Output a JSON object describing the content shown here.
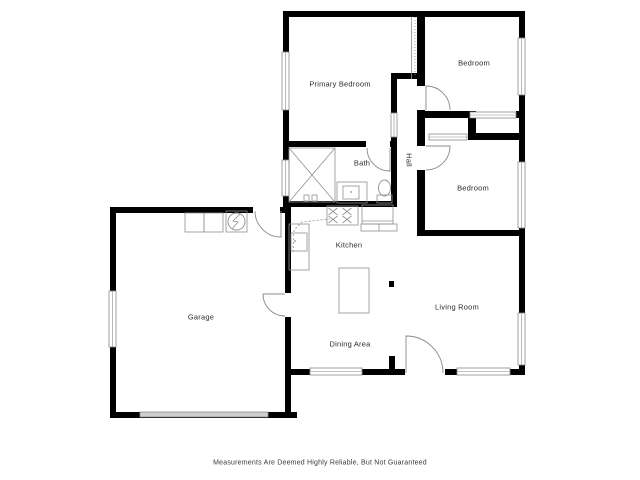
{
  "disclaimer": "Measurements Are Deemed Highly Reliable, But Not Guaranteed",
  "colors": {
    "wall": "#000000",
    "line": "#8a8a8a",
    "fixture": "#909090",
    "garage_door_fill": "#cfcfcf",
    "text": "#2b2b2b"
  },
  "rooms": [
    {
      "name": "primary-bedroom",
      "label": "Primary Bedroom",
      "cx": 340,
      "cy": 84
    },
    {
      "name": "bedroom-top",
      "label": "Bedroom",
      "cx": 474,
      "cy": 63
    },
    {
      "name": "bedroom-middle",
      "label": "Bedroom",
      "cx": 473,
      "cy": 188
    },
    {
      "name": "bath",
      "label": "Bath",
      "cx": 362,
      "cy": 163
    },
    {
      "name": "hall",
      "label": "Hall",
      "cx": 409,
      "cy": 160,
      "vertical": true
    },
    {
      "name": "kitchen",
      "label": "Kitchen",
      "cx": 349,
      "cy": 245
    },
    {
      "name": "garage",
      "label": "Garage",
      "cx": 201,
      "cy": 317
    },
    {
      "name": "living-room",
      "label": "Living Room",
      "cx": 457,
      "cy": 307
    },
    {
      "name": "dining-area",
      "label": "Dining Area",
      "cx": 350,
      "cy": 344
    }
  ],
  "floorplan": {
    "walls": [
      {
        "name": "wall-top",
        "x": 283,
        "y": 11,
        "w": 242,
        "h": 6
      },
      {
        "name": "wall-right",
        "x": 519,
        "y": 11,
        "w": 6,
        "h": 364
      },
      {
        "name": "wall-bottom",
        "x": 291,
        "y": 369,
        "w": 234,
        "h": 6
      },
      {
        "name": "wall-left-upper",
        "x": 283,
        "y": 11,
        "w": 6,
        "h": 196
      },
      {
        "name": "wall-primary-bottom",
        "x": 283,
        "y": 141,
        "w": 114,
        "h": 6
      },
      {
        "name": "wall-bath-bottom",
        "x": 283,
        "y": 201,
        "w": 114,
        "h": 6
      },
      {
        "name": "wall-bath-hall",
        "x": 391,
        "y": 73,
        "w": 6,
        "h": 134
      },
      {
        "name": "wall-hall-top",
        "x": 391,
        "y": 73,
        "w": 30,
        "h": 6
      },
      {
        "name": "wall-bedrooms-left",
        "x": 417,
        "y": 11,
        "w": 8,
        "h": 225
      },
      {
        "name": "wall-closet-top",
        "x": 417,
        "y": 111,
        "w": 53,
        "h": 7
      },
      {
        "name": "wall-closet-top-right",
        "x": 516,
        "y": 111,
        "w": 9,
        "h": 7
      },
      {
        "name": "wall-closet-divider",
        "x": 468,
        "y": 111,
        "w": 8,
        "h": 29
      },
      {
        "name": "wall-closet-bottom",
        "x": 468,
        "y": 133,
        "w": 57,
        "h": 7
      },
      {
        "name": "wall-bedroom2-bottom",
        "x": 417,
        "y": 230,
        "w": 108,
        "h": 6
      },
      {
        "name": "wall-garage-top",
        "x": 110,
        "y": 207,
        "w": 181,
        "h": 6
      },
      {
        "name": "wall-garage-left",
        "x": 110,
        "y": 207,
        "w": 6,
        "h": 211
      },
      {
        "name": "wall-garage-bottom",
        "x": 110,
        "y": 412,
        "w": 187,
        "h": 6
      },
      {
        "name": "wall-garage-right",
        "x": 285,
        "y": 207,
        "w": 6,
        "h": 211
      },
      {
        "name": "wall-entry-stub",
        "x": 389,
        "y": 356,
        "w": 6,
        "h": 19
      }
    ],
    "openings": [
      {
        "name": "opening-bedroom-top-door",
        "x": 416,
        "y": 86,
        "w": 10,
        "h": 24
      },
      {
        "name": "opening-bedroom-middle-door",
        "x": 416,
        "y": 146,
        "w": 10,
        "h": 24
      },
      {
        "name": "opening-bath-door",
        "x": 366,
        "y": 141,
        "w": 24,
        "h": 6
      },
      {
        "name": "opening-garage-entry",
        "x": 253,
        "y": 207,
        "w": 27,
        "h": 6
      },
      {
        "name": "opening-garage-side",
        "x": 285,
        "y": 293,
        "w": 6,
        "h": 24
      },
      {
        "name": "opening-front-door",
        "x": 405,
        "y": 369,
        "w": 40,
        "h": 6
      }
    ],
    "windows": [
      {
        "name": "window-primary-left",
        "x": 282,
        "y": 52,
        "w": 7,
        "h": 58
      },
      {
        "name": "window-bath-left",
        "x": 282,
        "y": 160,
        "w": 7,
        "h": 36
      },
      {
        "name": "window-bedroom-top-right",
        "x": 518,
        "y": 38,
        "w": 7,
        "h": 57
      },
      {
        "name": "window-bedroom-middle-right",
        "x": 518,
        "y": 162,
        "w": 7,
        "h": 66
      },
      {
        "name": "window-living-right",
        "x": 518,
        "y": 313,
        "w": 7,
        "h": 52
      },
      {
        "name": "window-dining-bottom",
        "x": 310,
        "y": 368,
        "w": 52,
        "h": 7
      },
      {
        "name": "window-living-bottom",
        "x": 457,
        "y": 368,
        "w": 53,
        "h": 7
      },
      {
        "name": "window-garage-left",
        "x": 109,
        "y": 291,
        "w": 7,
        "h": 56
      },
      {
        "name": "closet-door-bedroom-top",
        "x": 470,
        "y": 112,
        "w": 46,
        "h": 6
      },
      {
        "name": "closet-door-bedroom-middle",
        "x": 429,
        "y": 134,
        "w": 38,
        "h": 6
      },
      {
        "name": "opening-primary-hall",
        "x": 391,
        "y": 113,
        "w": 6,
        "h": 24
      }
    ],
    "garage_door": {
      "name": "garage-door",
      "x": 140,
      "y": 412,
      "w": 128,
      "h": 5
    },
    "doors": [
      {
        "name": "bedroom-top-door",
        "cx": 426,
        "cy": 110,
        "r": 24,
        "leaf": 270,
        "open": 0
      },
      {
        "name": "bedroom-middle-door",
        "cx": 426,
        "cy": 146,
        "r": 24,
        "leaf": 0,
        "open": 90
      },
      {
        "name": "bath-door",
        "cx": 390,
        "cy": 148,
        "r": 23,
        "leaf": 90,
        "open": 180
      },
      {
        "name": "garage-entry-door",
        "cx": 281,
        "cy": 211,
        "r": 26,
        "leaf": 90,
        "open": 180
      },
      {
        "name": "garage-side-door",
        "cx": 285,
        "cy": 294,
        "r": 22,
        "leaf": 180,
        "open": 90
      },
      {
        "name": "front-door",
        "cx": 406,
        "cy": 373,
        "r": 37,
        "leaf": 270,
        "open": 0
      }
    ],
    "fixtures": {
      "rects": [
        {
          "name": "shower",
          "x": 289,
          "y": 148,
          "w": 46,
          "h": 54
        },
        {
          "name": "shower-valve-left",
          "x": 304,
          "y": 195,
          "w": 5,
          "h": 6
        },
        {
          "name": "shower-valve-right",
          "x": 312,
          "y": 195,
          "w": 5,
          "h": 6
        },
        {
          "name": "bath-vanity",
          "x": 337,
          "y": 182,
          "w": 30,
          "h": 21
        },
        {
          "name": "bath-sink",
          "x": 343,
          "y": 186,
          "w": 16,
          "h": 13
        },
        {
          "name": "toilet-tank",
          "x": 377,
          "y": 195,
          "w": 15,
          "h": 8
        },
        {
          "name": "stove",
          "x": 327,
          "y": 206,
          "w": 31,
          "h": 19
        },
        {
          "name": "fridge",
          "x": 362,
          "y": 205,
          "w": 31,
          "h": 19
        },
        {
          "name": "counter-under-fridge",
          "x": 361,
          "y": 224,
          "w": 36,
          "h": 7
        },
        {
          "name": "counter-left",
          "x": 289,
          "y": 224,
          "w": 20,
          "h": 46
        },
        {
          "name": "kitchen-sink",
          "x": 291,
          "y": 233,
          "w": 16,
          "h": 18
        },
        {
          "name": "kitchen-island",
          "x": 339,
          "y": 268,
          "w": 30,
          "h": 45
        },
        {
          "name": "washer",
          "x": 185,
          "y": 213,
          "w": 19,
          "h": 19
        },
        {
          "name": "dryer",
          "x": 204,
          "y": 213,
          "w": 19,
          "h": 19
        },
        {
          "name": "water-heater",
          "x": 226,
          "y": 211,
          "w": 21,
          "h": 21
        },
        {
          "name": "structural-post",
          "x": 389,
          "y": 281,
          "w": 5,
          "h": 6,
          "fill": "wall"
        }
      ],
      "lines": [
        {
          "name": "shower-x-1",
          "x1": 289,
          "y1": 148,
          "x2": 335,
          "y2": 202
        },
        {
          "name": "shower-x-2",
          "x1": 335,
          "y1": 148,
          "x2": 289,
          "y2": 202
        },
        {
          "name": "fridge-front-line",
          "x1": 362,
          "y1": 221,
          "x2": 393,
          "y2": 221
        },
        {
          "name": "counter-tick",
          "x1": 379,
          "y1": 224,
          "x2": 379,
          "y2": 231
        },
        {
          "name": "attic-strip-line",
          "x1": 411.5,
          "y1": 17,
          "x2": 411.5,
          "y2": 79
        },
        {
          "name": "attic-strip-dots",
          "x1": 415,
          "y1": 17,
          "x2": 415,
          "y2": 77,
          "dash": "1,2"
        }
      ],
      "polylines": [
        {
          "name": "upper-cabinet-dashed",
          "points": [
            [
              293,
              252
            ],
            [
              294,
              230
            ],
            [
              302,
              222
            ],
            [
              330,
              219
            ]
          ],
          "dash": "2,2"
        },
        {
          "name": "water-heater-bolt",
          "points": [
            [
              240,
              214
            ],
            [
              233,
              221
            ],
            [
              238,
              222
            ],
            [
              232,
              229
            ]
          ]
        }
      ],
      "ellipses": [
        {
          "name": "toilet-bowl",
          "cx": 384.5,
          "cy": 188,
          "rx": 6,
          "ry": 8
        },
        {
          "name": "water-heater-circle",
          "cx": 236.5,
          "cy": 221.5,
          "rx": 8.5,
          "ry": 8.5
        }
      ],
      "dots": [
        {
          "name": "kitchen-sink-faucet",
          "cx": 295,
          "cy": 241
        },
        {
          "name": "vanity-faucet",
          "cx": 351,
          "cy": 192
        }
      ],
      "crosses": [
        {
          "name": "burner-1",
          "cx": 333,
          "cy": 211.5
        },
        {
          "name": "burner-2",
          "cx": 347,
          "cy": 211.5
        },
        {
          "name": "burner-3",
          "cx": 333,
          "cy": 219.5
        },
        {
          "name": "burner-4",
          "cx": 347,
          "cy": 219.5
        }
      ]
    }
  }
}
